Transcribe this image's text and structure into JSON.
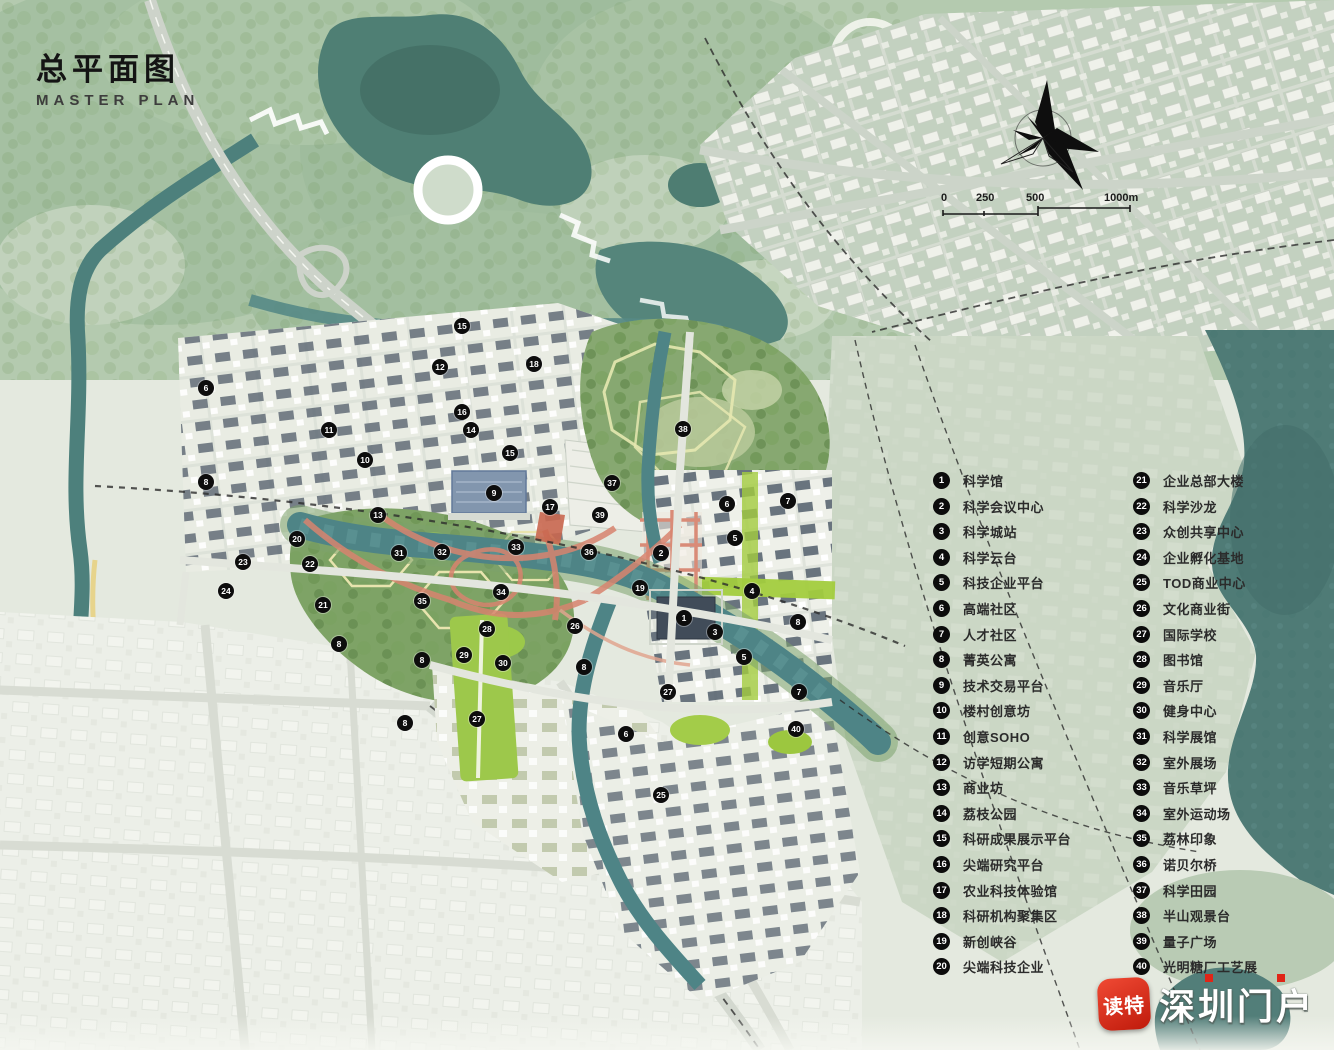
{
  "title": {
    "zh": "总平面图",
    "en": "MASTER PLAN"
  },
  "scale_bar": {
    "labels": [
      "0",
      "250",
      "500",
      "1000m"
    ]
  },
  "legend": {
    "left": [
      {
        "num": "1",
        "label": "科学馆"
      },
      {
        "num": "2",
        "label": "科学会议中心"
      },
      {
        "num": "3",
        "label": "科学城站"
      },
      {
        "num": "4",
        "label": "科学云台"
      },
      {
        "num": "5",
        "label": "科技企业平台"
      },
      {
        "num": "6",
        "label": "高端社区"
      },
      {
        "num": "7",
        "label": "人才社区"
      },
      {
        "num": "8",
        "label": "菁英公寓"
      },
      {
        "num": "9",
        "label": "技术交易平台"
      },
      {
        "num": "10",
        "label": "楼村创意坊"
      },
      {
        "num": "11",
        "label": "创意SOHO"
      },
      {
        "num": "12",
        "label": "访学短期公寓"
      },
      {
        "num": "13",
        "label": "商业坊"
      },
      {
        "num": "14",
        "label": "荔枝公园"
      },
      {
        "num": "15",
        "label": "科研成果展示平台"
      },
      {
        "num": "16",
        "label": "尖端研究平台"
      },
      {
        "num": "17",
        "label": "农业科技体验馆"
      },
      {
        "num": "18",
        "label": "科研机构聚集区"
      },
      {
        "num": "19",
        "label": "新创峡谷"
      },
      {
        "num": "20",
        "label": "尖端科技企业"
      }
    ],
    "right": [
      {
        "num": "21",
        "label": "企业总部大楼"
      },
      {
        "num": "22",
        "label": "科学沙龙"
      },
      {
        "num": "23",
        "label": "众创共享中心"
      },
      {
        "num": "24",
        "label": "企业孵化基地"
      },
      {
        "num": "25",
        "label": "TOD商业中心"
      },
      {
        "num": "26",
        "label": "文化商业街"
      },
      {
        "num": "27",
        "label": "国际学校"
      },
      {
        "num": "28",
        "label": "图书馆"
      },
      {
        "num": "29",
        "label": "音乐厅"
      },
      {
        "num": "30",
        "label": "健身中心"
      },
      {
        "num": "31",
        "label": "科学展馆"
      },
      {
        "num": "32",
        "label": "室外展场"
      },
      {
        "num": "33",
        "label": "音乐草坪"
      },
      {
        "num": "34",
        "label": "室外运动场"
      },
      {
        "num": "35",
        "label": "荔林印象"
      },
      {
        "num": "36",
        "label": "诺贝尔桥"
      },
      {
        "num": "37",
        "label": "科学田园"
      },
      {
        "num": "38",
        "label": "半山观景台"
      },
      {
        "num": "39",
        "label": "量子广场"
      },
      {
        "num": "40",
        "label": "光明糖厂工艺展"
      }
    ]
  },
  "map": {
    "markers": [
      {
        "n": "1",
        "x": 684,
        "y": 618
      },
      {
        "n": "2",
        "x": 661,
        "y": 553
      },
      {
        "n": "3",
        "x": 715,
        "y": 632
      },
      {
        "n": "4",
        "x": 752,
        "y": 591
      },
      {
        "n": "5",
        "x": 735,
        "y": 538
      },
      {
        "n": "5",
        "x": 744,
        "y": 657
      },
      {
        "n": "6",
        "x": 206,
        "y": 388
      },
      {
        "n": "6",
        "x": 626,
        "y": 734
      },
      {
        "n": "6",
        "x": 727,
        "y": 504
      },
      {
        "n": "7",
        "x": 788,
        "y": 501
      },
      {
        "n": "7",
        "x": 799,
        "y": 692
      },
      {
        "n": "8",
        "x": 206,
        "y": 482
      },
      {
        "n": "8",
        "x": 339,
        "y": 644
      },
      {
        "n": "8",
        "x": 422,
        "y": 660
      },
      {
        "n": "8",
        "x": 584,
        "y": 667
      },
      {
        "n": "8",
        "x": 798,
        "y": 622
      },
      {
        "n": "8",
        "x": 405,
        "y": 723
      },
      {
        "n": "9",
        "x": 494,
        "y": 493
      },
      {
        "n": "10",
        "x": 365,
        "y": 460
      },
      {
        "n": "11",
        "x": 329,
        "y": 430
      },
      {
        "n": "12",
        "x": 440,
        "y": 367
      },
      {
        "n": "13",
        "x": 378,
        "y": 515
      },
      {
        "n": "14",
        "x": 471,
        "y": 430
      },
      {
        "n": "15",
        "x": 462,
        "y": 326
      },
      {
        "n": "15",
        "x": 510,
        "y": 453
      },
      {
        "n": "16",
        "x": 462,
        "y": 412
      },
      {
        "n": "17",
        "x": 550,
        "y": 507
      },
      {
        "n": "18",
        "x": 534,
        "y": 364
      },
      {
        "n": "19",
        "x": 640,
        "y": 588
      },
      {
        "n": "20",
        "x": 297,
        "y": 539
      },
      {
        "n": "21",
        "x": 323,
        "y": 605
      },
      {
        "n": "22",
        "x": 310,
        "y": 564
      },
      {
        "n": "23",
        "x": 243,
        "y": 562
      },
      {
        "n": "24",
        "x": 226,
        "y": 591
      },
      {
        "n": "25",
        "x": 661,
        "y": 795
      },
      {
        "n": "26",
        "x": 575,
        "y": 626
      },
      {
        "n": "27",
        "x": 477,
        "y": 719
      },
      {
        "n": "27",
        "x": 668,
        "y": 692
      },
      {
        "n": "28",
        "x": 487,
        "y": 629
      },
      {
        "n": "29",
        "x": 464,
        "y": 655
      },
      {
        "n": "30",
        "x": 503,
        "y": 663
      },
      {
        "n": "31",
        "x": 399,
        "y": 553
      },
      {
        "n": "32",
        "x": 442,
        "y": 552
      },
      {
        "n": "33",
        "x": 516,
        "y": 547
      },
      {
        "n": "34",
        "x": 501,
        "y": 592
      },
      {
        "n": "35",
        "x": 422,
        "y": 601
      },
      {
        "n": "36",
        "x": 589,
        "y": 552
      },
      {
        "n": "37",
        "x": 612,
        "y": 483
      },
      {
        "n": "38",
        "x": 683,
        "y": 429
      },
      {
        "n": "39",
        "x": 600,
        "y": 515
      },
      {
        "n": "40",
        "x": 796,
        "y": 729
      }
    ]
  },
  "watermark": {
    "app": "读特",
    "site": "深圳门户"
  },
  "colors": {
    "legend_badge": "#0c0c0c",
    "marker": "#0d0d0d",
    "water": "#4f8083",
    "lake_east": "#4f7b76",
    "hill_green": "#b4caaf",
    "forest_green": "#87a871",
    "park_bright_green": "#9dc84b",
    "red_path": "#d8846f",
    "watermark_red": "#d92b1a",
    "station_blue": "#8296ae"
  }
}
